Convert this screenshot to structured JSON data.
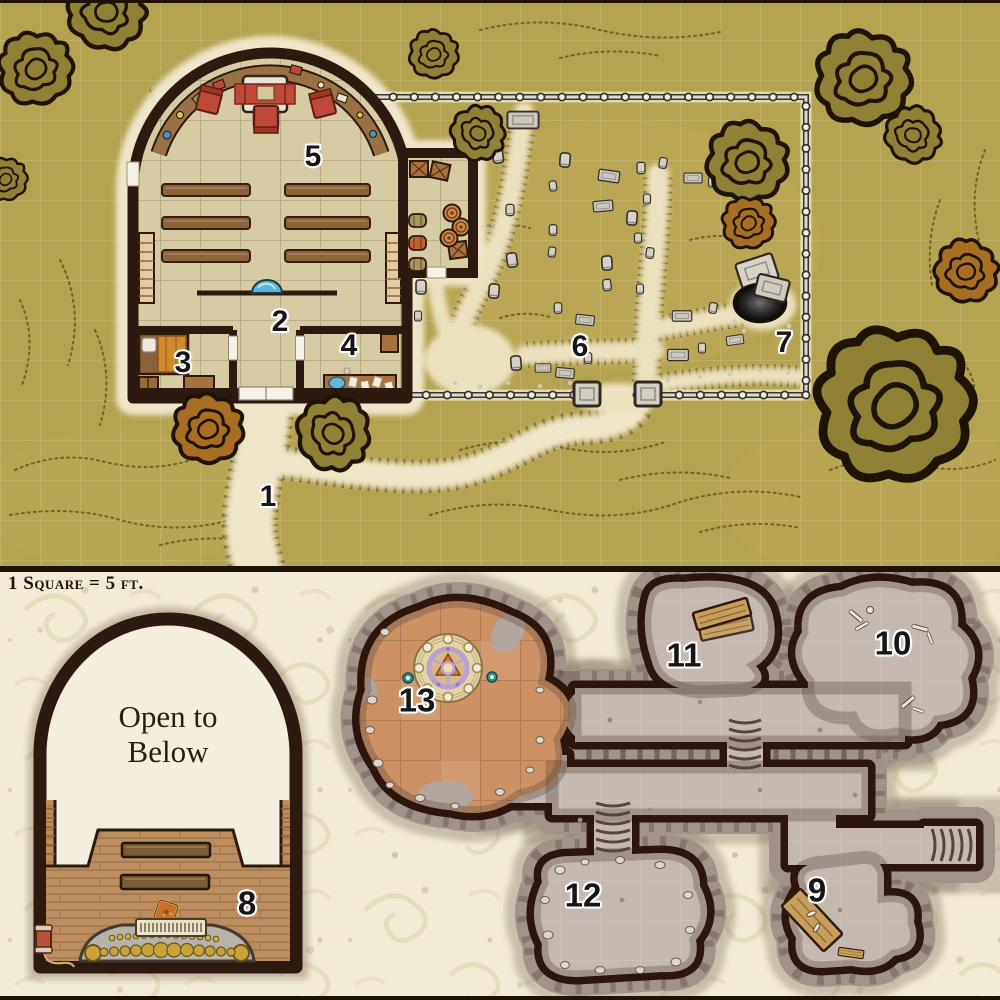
{
  "scale_label": "1 Square = 5 ft.",
  "upper_map": {
    "name": "chapel, grounds and graveyard (ground level)",
    "room_numbers": {
      "r1": "1",
      "r2": "2",
      "r3": "3",
      "r4": "4",
      "r5": "5",
      "r6": "6",
      "r7": "7"
    }
  },
  "lower_map": {
    "name": "balcony level and caves beneath",
    "open_to_below_line1": "Open to",
    "open_to_below_line2": "Below",
    "room_numbers": {
      "r8": "8",
      "r9": "9",
      "r10": "10",
      "r11": "11",
      "r12": "12",
      "r13": "13"
    }
  },
  "features": {
    "upper": [
      "chapel-building",
      "altar",
      "celebrant-chairs",
      "pew-benches",
      "baptismal-font",
      "side-stairs",
      "bed",
      "storage-chest",
      "side-table",
      "washstand",
      "storage-annex",
      "crates",
      "barrels",
      "graveyard-fence",
      "gate-pillars",
      "gravestones",
      "open-grave",
      "dirt-paths",
      "trees"
    ],
    "lower": [
      "balcony-arch",
      "open-to-below-void",
      "balcony-benches",
      "pipe-organ",
      "rope-spool",
      "kneeling-cushion",
      "cave-complex",
      "rope-ladders",
      "summoning-circle",
      "candles",
      "wood-planks",
      "bones",
      "rubble-stones"
    ]
  },
  "colors": {
    "terrain": "#b4a351",
    "path_cream": "#efe5c8",
    "tree_olive": "#8f8136",
    "tree_orange": "#a86e22",
    "wall_dark": "#2c1a10",
    "floor_tile": "#d7cba4",
    "wood": "#a9713c",
    "accent_red": "#bf4937",
    "water_blue": "#5ab6d8",
    "parchment": "#f1ead6",
    "cave_floor": "#c4b8b1",
    "cave_rubble": "#a2938a",
    "terracotta": "#cd9164",
    "stone_gray": "#d6d1c7",
    "gold": "#c9a23a"
  }
}
